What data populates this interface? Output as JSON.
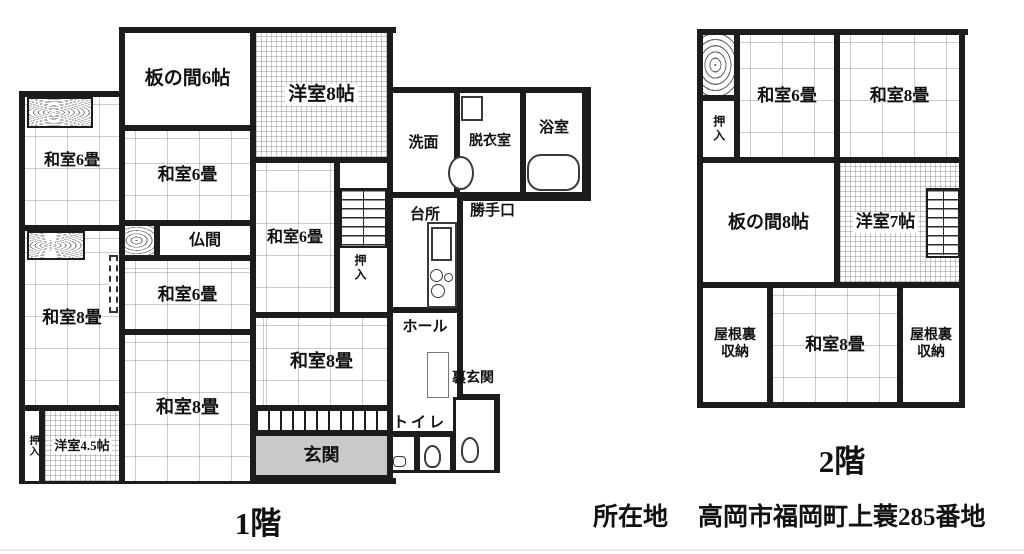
{
  "floors": {
    "floor1": {
      "caption": "1階",
      "rooms": {
        "itanoma6": "板の間6帖",
        "yoshitsu8": "洋室8帖",
        "washitsu6_left": "和室6畳",
        "washitsu6_mid": "和室6畳",
        "washitsu6_center": "和室6畳",
        "washitsu6_right": "和室6畳",
        "butsuma": "仏間",
        "washitsu8_left": "和室8畳",
        "washitsu8_mid": "和室8畳",
        "washitsu8_right": "和室8畳",
        "yoshitsu45": "洋室4.5帖",
        "oshiire_left": "押入",
        "oshiire_stairs": "押入",
        "senmen": "洗面",
        "datsuishitsu": "脱衣室",
        "yokushitsu": "浴室",
        "daidokoro": "台所",
        "katteguchi": "勝手口",
        "hall": "ホール",
        "uragenkan": "裏玄関",
        "toilet": "トイレ",
        "genkan": "玄関"
      }
    },
    "floor2": {
      "caption": "2階",
      "rooms": {
        "oshiire": "押入",
        "washitsu6": "和室6畳",
        "washitsu8_top": "和室8畳",
        "itanoma8": "板の間8帖",
        "yoshitsu7": "洋室7帖",
        "yaneura_left": "屋根裏収納",
        "washitsu8_bottom": "和室8畳",
        "yaneura_right": "屋根裏収納"
      }
    }
  },
  "address": {
    "label": "所在地",
    "value": "高岡市福岡町上蓑285番地"
  },
  "colors": {
    "wall": "#1c1c1c",
    "entry_fill": "#c9c9c9",
    "paper": "#ffffff"
  }
}
